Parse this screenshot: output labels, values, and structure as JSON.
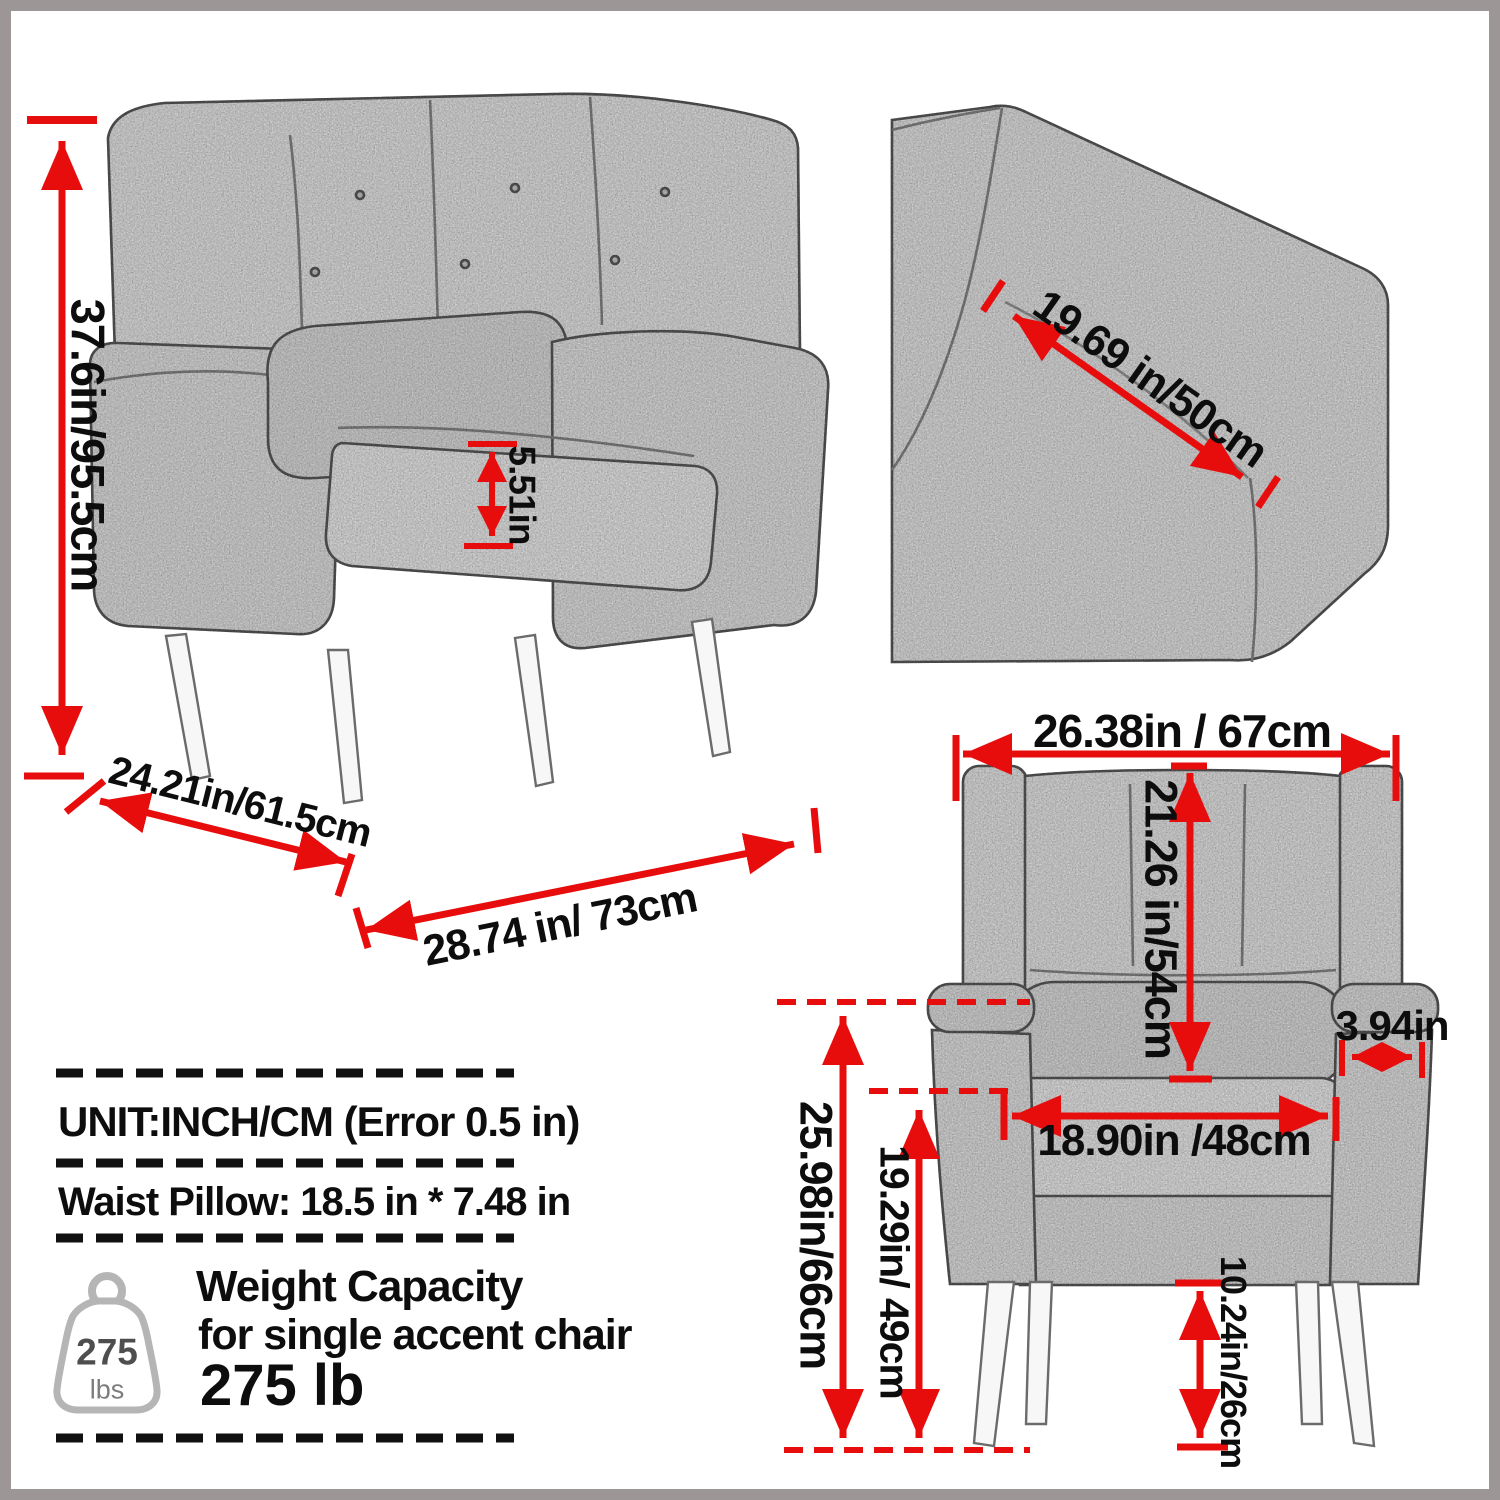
{
  "palette": {
    "accent_red": "#e80d0d",
    "frame_gray": "#9d9696",
    "sketch_stroke": "#5f5f5f",
    "paper": "#ffffff"
  },
  "perspective_view": {
    "overall_height": "37.6in/95.5cm",
    "seat_cushion_thickness": "5.51in",
    "depth": "24.21in/61.5cm",
    "width": "28.74 in/ 73cm"
  },
  "closeup_view": {
    "seat_back_width": "19.69 in/50cm"
  },
  "front_view": {
    "overall_width": "26.38in / 67cm",
    "backrest_height": "21.26 in/54cm",
    "armrest_width": "3.94in",
    "seat_width": "18.90in /48cm",
    "armrest_height": "25.98in/66cm",
    "seat_to_floor": "19.29in/ 49cm",
    "leg_height": "10.24in/26cm"
  },
  "notes": {
    "unit": "UNIT:INCH/CM (Error 0.5 in)",
    "waist_pillow": "Waist Pillow: 18.5 in * 7.48 in"
  },
  "weight_capacity": {
    "title": "Weight Capacity",
    "subtitle": "for single accent chair",
    "value": "275 lb",
    "icon_value": "275",
    "icon_unit": "lbs"
  }
}
